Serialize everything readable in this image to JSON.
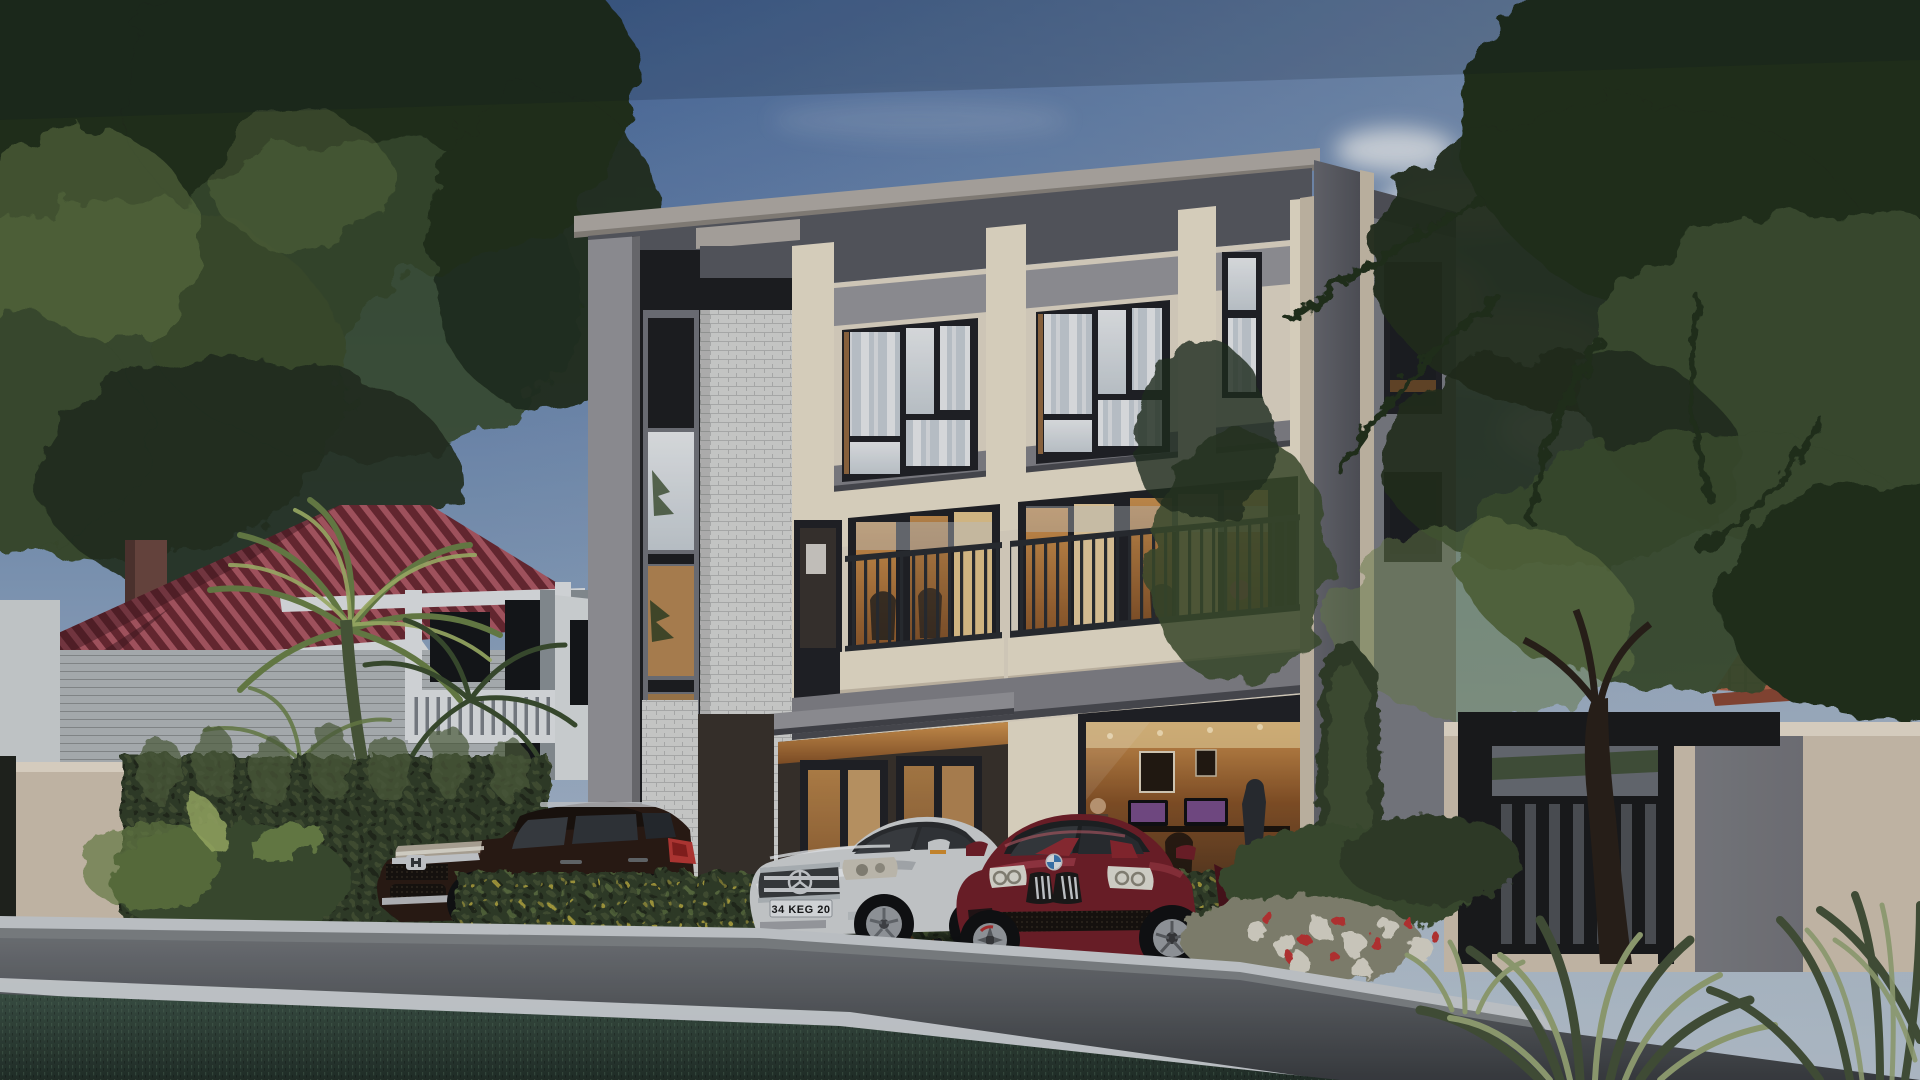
{
  "scene": {
    "type": "architectural-exterior-render",
    "time_of_day": "dusk",
    "license_plate": "34 KEG 20",
    "description": "Modern three-story cream and gray townhouse with balconies and warm lit interiors, white brick feature column, dark entry gate at right, neighboring maroon-roof house with palms at left, cypress hedges, and three parked cars (dark brown SUV, silver coupe, dark red coupe) along a dusk street.",
    "objects": [
      "sky",
      "clouds",
      "bird",
      "background-trees",
      "neighbor-house",
      "chimney",
      "porch",
      "palm-trees",
      "cypress-hedge",
      "main-building",
      "brick-column",
      "balconies",
      "entrance",
      "office-interior",
      "side-wing",
      "garden-gate",
      "boundary-wall",
      "front-hedge",
      "flower-bed",
      "honda-suv",
      "mercedes-sedan",
      "bmw-coupe",
      "street",
      "curb",
      "road-marking",
      "foreground-lawn",
      "spiky-plants",
      "tree-trunk"
    ],
    "car_count": 3
  },
  "colors": {
    "sky_top": "#44689f",
    "sky_mid": "#8aa3c2",
    "sky_low": "#ccd6de",
    "sky_right": "#b5c2cf",
    "cloud": "#eef1f3",
    "leaf_dark": "#22301f",
    "leaf_mid": "#3c4f30",
    "leaf_light": "#6d8449",
    "leaf_bright": "#a9bb6d",
    "roof_red": "#6e2a34",
    "roof_red_hi": "#b25a66",
    "roof_red_dk": "#401720",
    "trim_white": "#e7e9ea",
    "siding": "#b7bcbe",
    "siding_dk": "#8f969a",
    "opening_dark": "#15171a",
    "chimney": "#6f4a42",
    "beige": "#d6c7b4",
    "beige_dk": "#b3a491",
    "hedge_dark": "#333f2b",
    "hedge_hi": "#53633f",
    "hedge_yellow": "#c9b944",
    "cream": "#e7ddca",
    "cream_lit": "#efe4cf",
    "cream_dk": "#cfc3ae",
    "panel_gray": "#9a999d",
    "panel_gray_dk": "#85848a",
    "fascia": "#5a5b63",
    "cap_gray": "#b6b0a9",
    "frame_dark": "#212227",
    "glass_lite": "#ccd3d8",
    "glass_white": "#eef0f1",
    "glass_dark": "#1d1f23",
    "warm": "#d99a52",
    "warm_deep": "#8a5428",
    "interior_dark": "#33261c",
    "brick_white": "#dbdbd9",
    "brick_line": "#b9bab8",
    "mosaic": "#1e1f22",
    "side_gray": "#6a6b72",
    "side_gray_dk": "#54555c",
    "rail_dark": "#2a2e33",
    "gate_dark": "#1a1b1d",
    "gate_slat": "#515459",
    "road": "#5b5e62",
    "road_hi": "#74777b",
    "road_dk": "#3c3f43",
    "curb": "#d0d4d6",
    "line_white": "#dfe3e5",
    "grass": "#3d5347",
    "grass_dk": "#23312a",
    "grass_hi": "#5c7a64",
    "suv_body": "#2b1b15",
    "suv_hi": "#553c31",
    "chrome": "#d2d5d7",
    "lamp": "#b9b0a0",
    "tail_red": "#bf3a36",
    "mb_silver": "#d6d8d9",
    "mb_shadow": "#a2a7aa",
    "mb_dark": "#2c2f31",
    "bmw_red": "#74202a",
    "bmw_hi": "#a63f4b",
    "bmw_dk": "#4b141c",
    "tire": "#101113",
    "alloy": "#9da1a5",
    "alloy_dk": "#5d6064",
    "flower_red": "#c23434",
    "flower_white": "#e0dbcd",
    "screen": "#7b4f8d",
    "suit": "#2a2d33",
    "tile_orange": "#b8674b",
    "tile_orange_dk": "#8f4936",
    "roof_gray": "#9b9691",
    "trunk": "#2a211a",
    "spike_dark": "#46543a",
    "spike_hi": "#9aa878",
    "plate_bg": "#e9ebec",
    "plate_text": "#17181a"
  }
}
